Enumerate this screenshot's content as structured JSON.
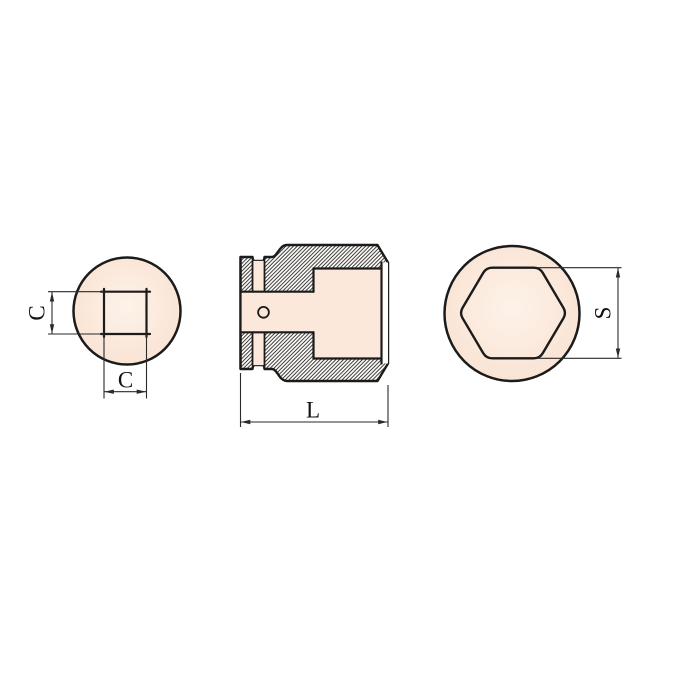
{
  "drawing": {
    "dimensions": {
      "square_height_label": "C",
      "square_width_label": "C",
      "length_label": "L",
      "hex_size_label": "S"
    },
    "colors": {
      "background": "#ffffff",
      "line": "#1b1b1b",
      "dimension": "#2a2a2a",
      "text": "#111111",
      "fill_peach": "#fbe8da",
      "fill_light": "#fdf3ea",
      "fill_edge": "#f8e2d2",
      "hatch_background": "#fffdf9"
    }
  }
}
